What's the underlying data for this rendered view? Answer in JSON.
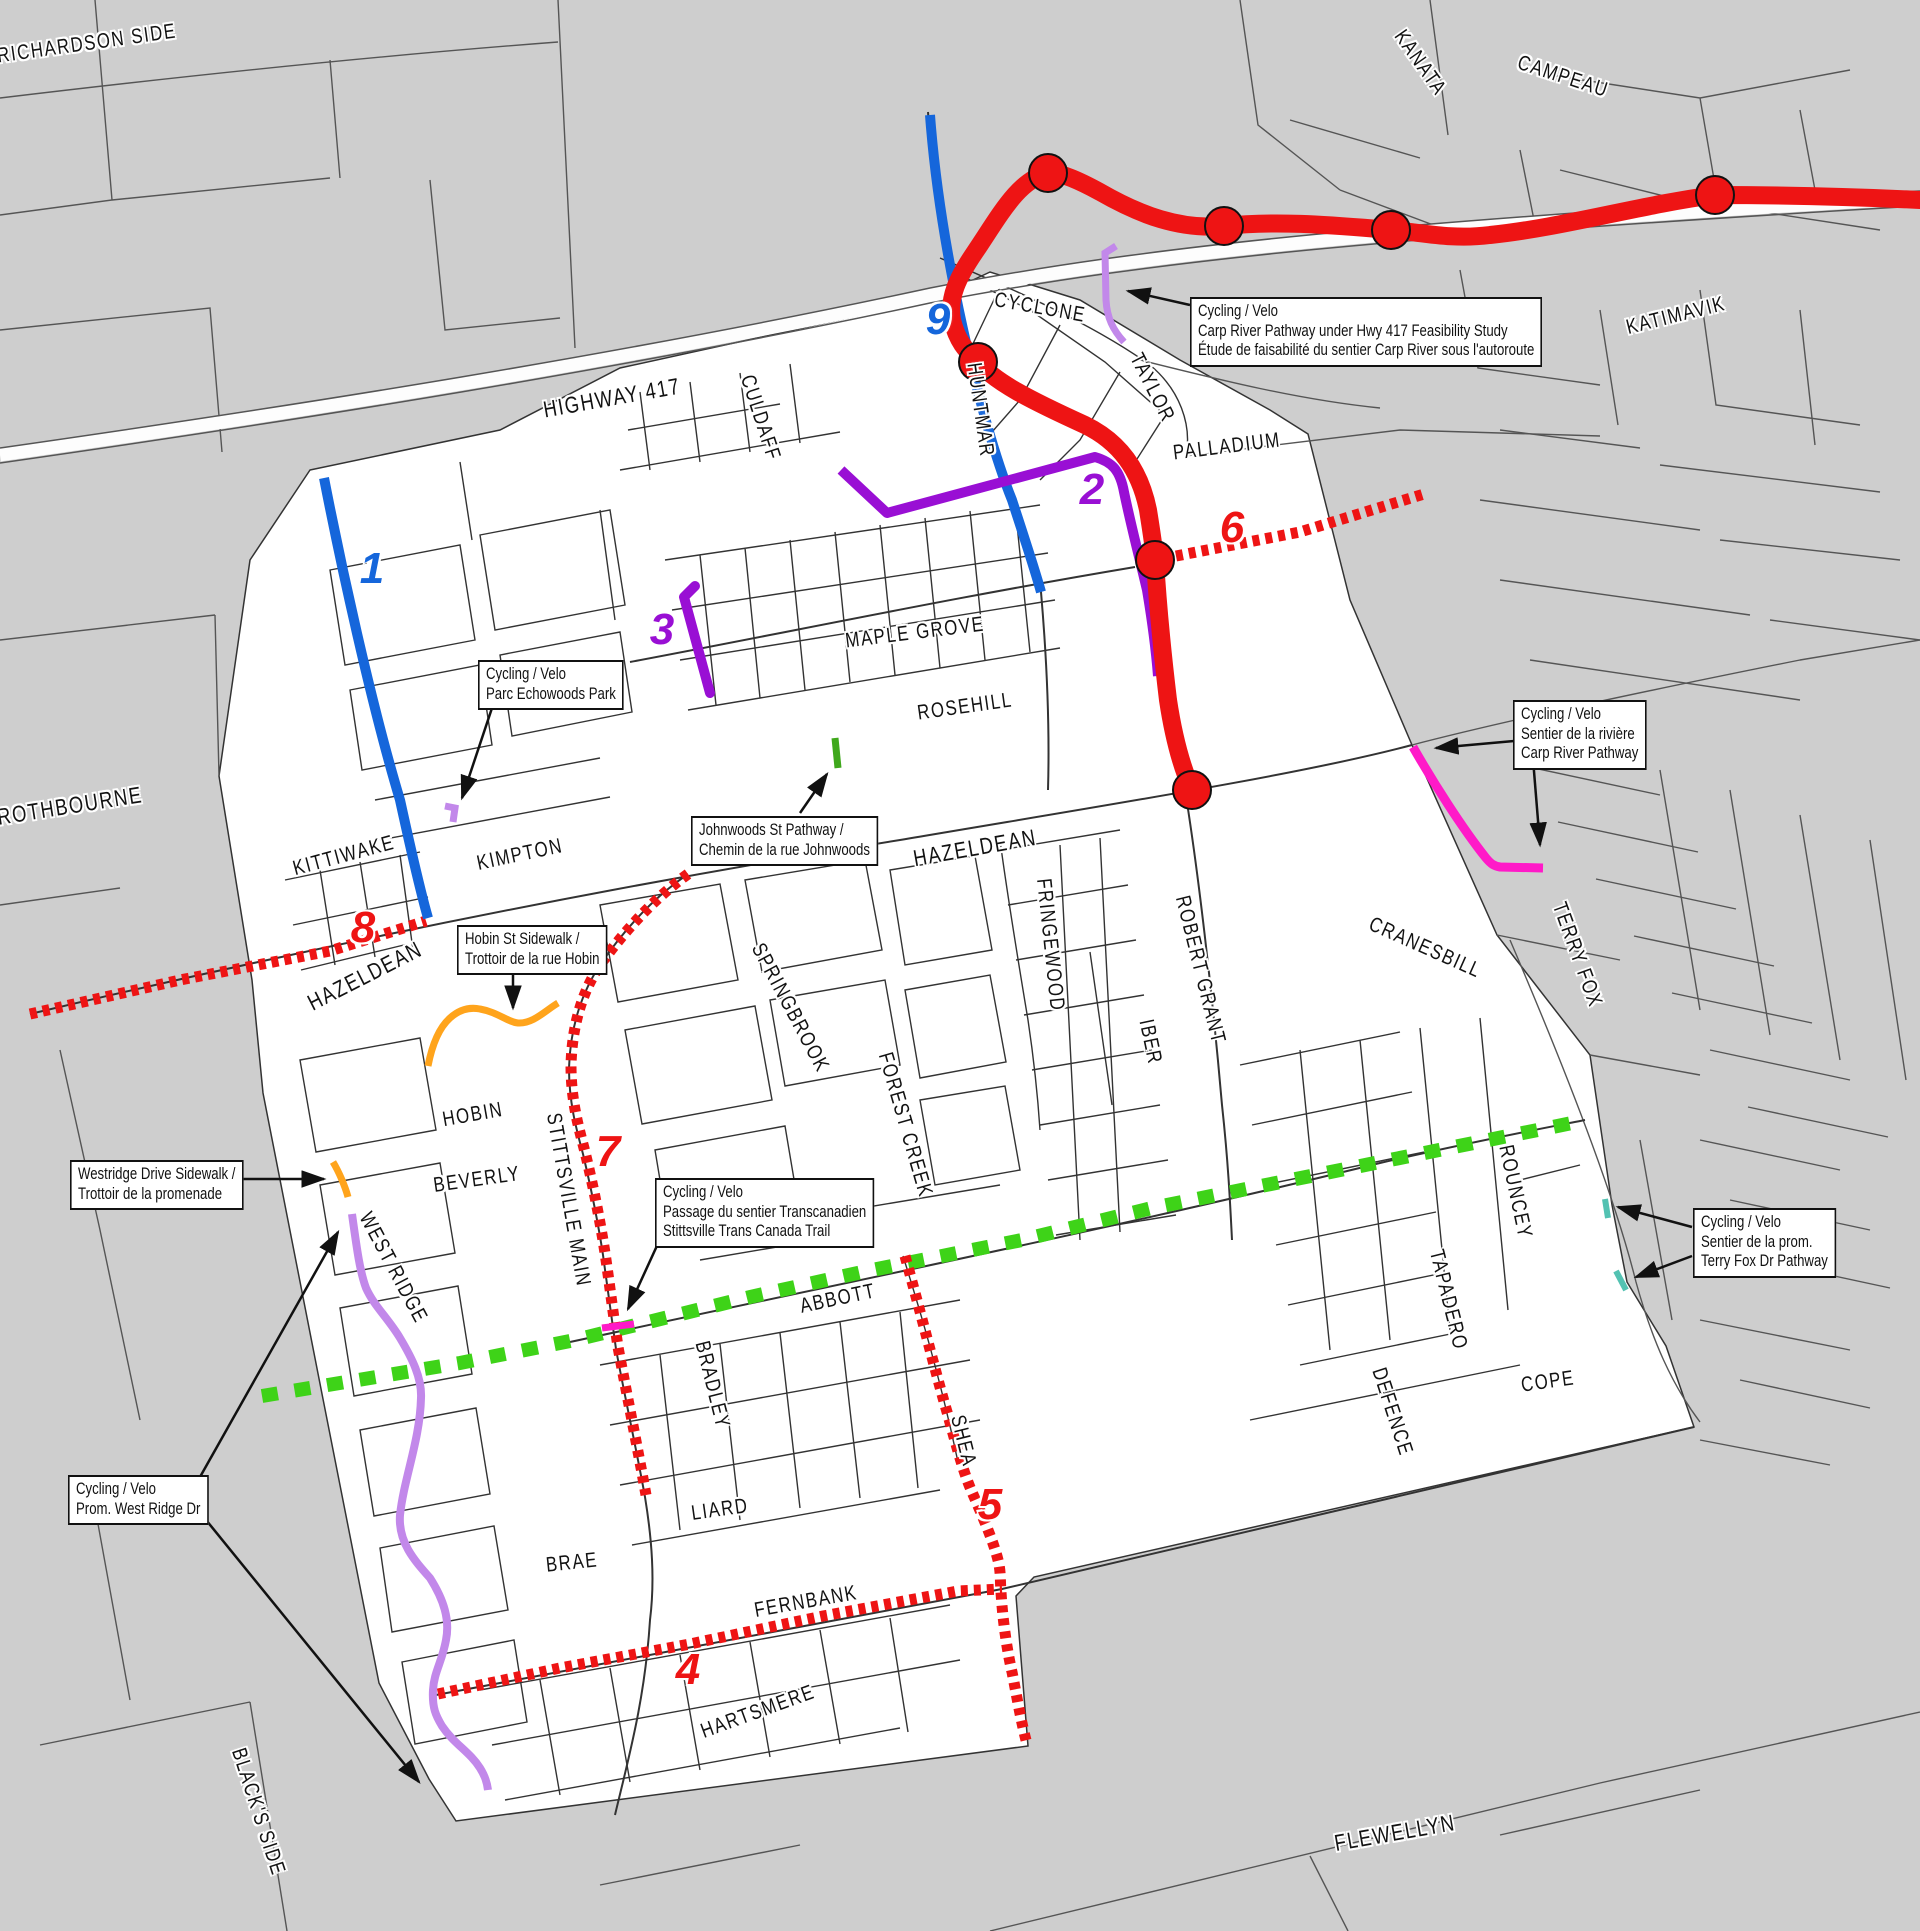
{
  "map": {
    "colors": {
      "bg": "#cecece",
      "area": "#ffffff",
      "road": "#3f3f3f",
      "red": "#ee1414",
      "blue": "#1566db",
      "purple": "#990fd4",
      "lavender": "#c288ea",
      "pink": "#ff1ac8",
      "orange": "#ffa41c",
      "green": "#3ed318",
      "green_dark": "#3fa81c",
      "teal": "#53c2b2"
    },
    "road_labels": [
      {
        "text": "RICHARDSON SIDE"
      },
      {
        "text": "KANATA"
      },
      {
        "text": "CAMPEAU"
      },
      {
        "text": "KATIMAVIK"
      },
      {
        "text": "HIGHWAY 417"
      },
      {
        "text": "CYCLONE"
      },
      {
        "text": "TAYLOR"
      },
      {
        "text": "HUNTMAR"
      },
      {
        "text": "CULDAFF"
      },
      {
        "text": "PALLADIUM"
      },
      {
        "text": "MAPLE GROVE"
      },
      {
        "text": "ROSEHILL"
      },
      {
        "text": "HAZELDEAN"
      },
      {
        "text": "FRINGEWOOD"
      },
      {
        "text": "IBER"
      },
      {
        "text": "ROBERT GRANT"
      },
      {
        "text": "HAZELDEAN"
      },
      {
        "text": "KIMPTON"
      },
      {
        "text": "KITTIWAKE"
      },
      {
        "text": "ROTHBOURNE"
      },
      {
        "text": "CRANESBILL"
      },
      {
        "text": "TERRY FOX"
      },
      {
        "text": "SPRINGBROOK"
      },
      {
        "text": "FOREST CREEK"
      },
      {
        "text": "HOBIN"
      },
      {
        "text": "BEVERLY"
      },
      {
        "text": "WEST RIDGE"
      },
      {
        "text": "STITTSVILLE MAIN"
      },
      {
        "text": "ABBOTT"
      },
      {
        "text": "BRADLEY"
      },
      {
        "text": "LIARD"
      },
      {
        "text": "SHEA"
      },
      {
        "text": "BRAE"
      },
      {
        "text": "FERNBANK"
      },
      {
        "text": "HARTSMERE"
      },
      {
        "text": "FLEWELLYN"
      },
      {
        "text": "BLACK'S SIDE"
      },
      {
        "text": "ROUNCEY"
      },
      {
        "text": "TAPADERO"
      },
      {
        "text": "DEFENCE"
      },
      {
        "text": "COPE"
      }
    ],
    "markers": [
      {
        "n": "1",
        "color": "blue"
      },
      {
        "n": "2",
        "color": "purple"
      },
      {
        "n": "3",
        "color": "purple"
      },
      {
        "n": "4",
        "color": "red"
      },
      {
        "n": "5",
        "color": "red"
      },
      {
        "n": "6",
        "color": "red"
      },
      {
        "n": "7",
        "color": "red"
      },
      {
        "n": "8",
        "color": "red"
      },
      {
        "n": "9",
        "color": "blue"
      }
    ],
    "callouts": [
      {
        "id": "carp-hwy417-study",
        "lines": [
          "Cycling / Velo",
          "Carp River Pathway under Hwy 417 Feasibility Study",
          "Étude de faisabilité du sentier Carp River sous l'autoroute"
        ]
      },
      {
        "id": "echowoods-park",
        "lines": [
          "Cycling / Velo",
          "Parc Echowoods Park"
        ]
      },
      {
        "id": "johnwoods-pathway",
        "lines": [
          "Johnwoods St Pathway /",
          "Chemin de la rue Johnwoods"
        ]
      },
      {
        "id": "hobin-sidewalk",
        "lines": [
          "Hobin St Sidewalk /",
          "Trottoir de la rue Hobin"
        ]
      },
      {
        "id": "westridge-sidewalk",
        "lines": [
          "Westridge Drive Sidewalk /",
          "Trottoir de la promenade"
        ]
      },
      {
        "id": "prom-west-ridge",
        "lines": [
          "Cycling / Velo",
          "Prom. West Ridge Dr"
        ]
      },
      {
        "id": "trans-canada-trail",
        "lines": [
          "Cycling / Velo",
          "Passage du sentier Transcanadien",
          "Stittsville Trans Canada Trail"
        ]
      },
      {
        "id": "carp-river-pathway",
        "lines": [
          "Cycling / Velo",
          "Sentier de la rivière",
          "Carp River Pathway"
        ]
      },
      {
        "id": "terry-fox-pathway",
        "lines": [
          "Cycling / Velo",
          "Sentier de la prom.",
          "Terry Fox Dr Pathway"
        ]
      }
    ],
    "routes": [
      {
        "number": "1",
        "color": "blue",
        "style": "solid"
      },
      {
        "number": "2",
        "color": "purple",
        "style": "solid"
      },
      {
        "number": "3",
        "color": "purple",
        "style": "solid"
      },
      {
        "number": "4",
        "color": "red",
        "style": "dotted"
      },
      {
        "number": "5",
        "color": "red",
        "style": "dotted"
      },
      {
        "number": "6",
        "color": "red",
        "style": "dotted"
      },
      {
        "number": "7",
        "color": "red",
        "style": "dotted"
      },
      {
        "number": "8",
        "color": "red",
        "style": "dotted"
      },
      {
        "number": "9",
        "color": "blue",
        "style": "solid"
      },
      {
        "number": "",
        "color": "red",
        "style": "solid-with-nodes"
      },
      {
        "number": "",
        "color": "green",
        "style": "dashed"
      }
    ]
  }
}
